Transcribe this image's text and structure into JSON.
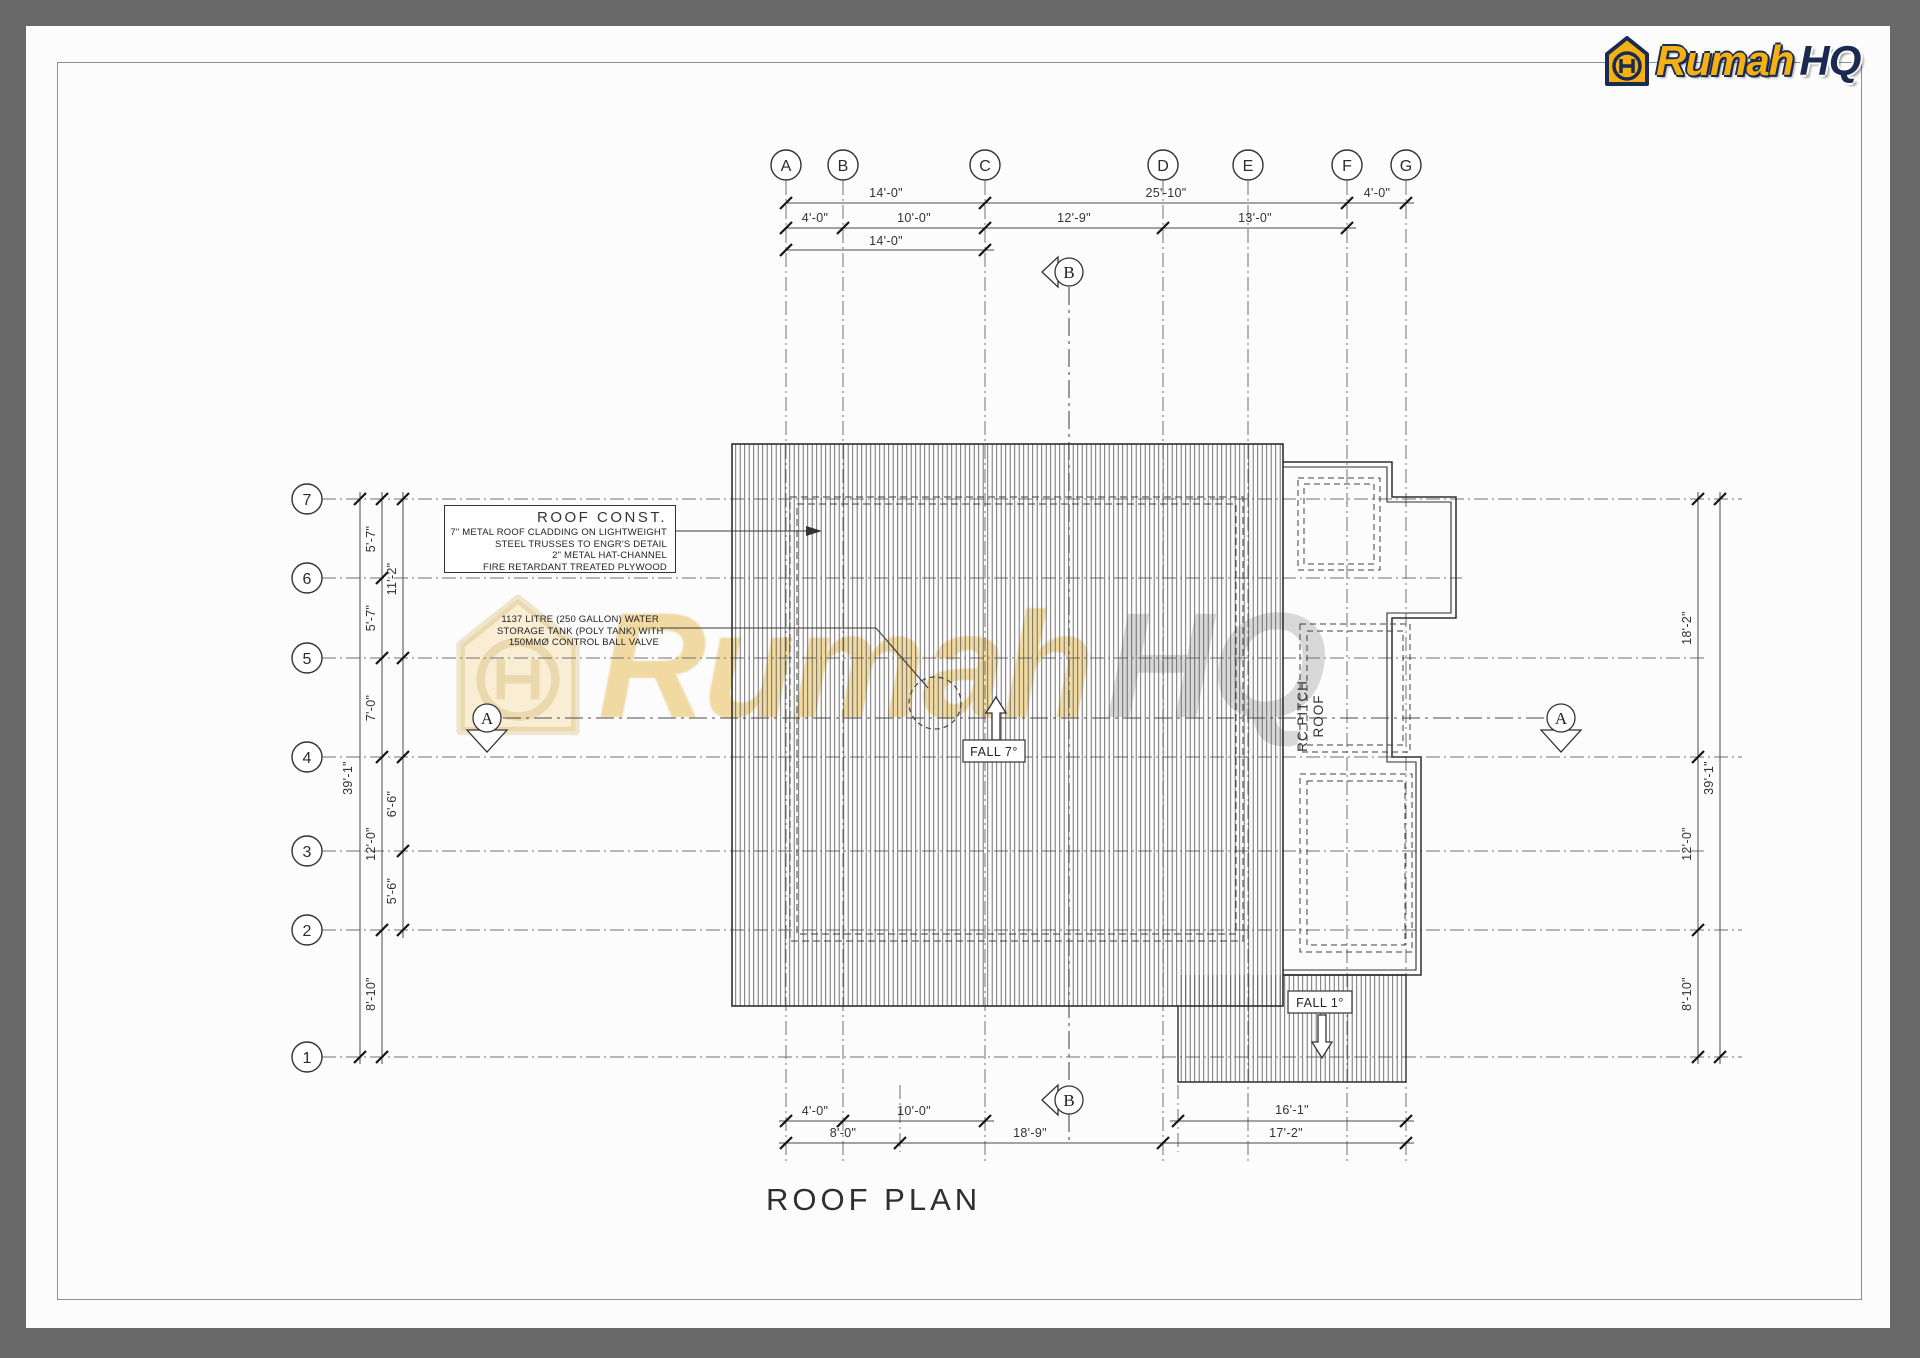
{
  "brand": {
    "prefix": "Rumah",
    "suffix": "HQ"
  },
  "watermark": {
    "prefix": "Rumah",
    "suffix": "HQ"
  },
  "drawing_title": "ROOF PLAN",
  "grid": {
    "columns": [
      "A",
      "B",
      "C",
      "D",
      "E",
      "F",
      "G"
    ],
    "rows": [
      "7",
      "6",
      "5",
      "4",
      "3",
      "2",
      "1"
    ]
  },
  "sections": {
    "a_left": "A",
    "a_right": "A",
    "b_top": "B",
    "b_bottom": "B"
  },
  "dims": {
    "top_row1": [
      "14'-0\"",
      "25'-10\"",
      "4'-0\""
    ],
    "top_row2": [
      "4'-0\"",
      "10'-0\"",
      "12'-9\"",
      "13'-0\""
    ],
    "top_row3": [
      "14'-0\""
    ],
    "left_overall": "39'-1\"",
    "left_chain": [
      "5'-7\"",
      "5'-7\"",
      "7'-0\"",
      "12'-0\"",
      "8'-10\""
    ],
    "left_outer": [
      "11'-2\"",
      "6'-6\"",
      "5'-6\""
    ],
    "right_chain": [
      "18'-2\"",
      "12'-0\"",
      "8'-10\""
    ],
    "right_overall": "39'-1\"",
    "bottom_row1": [
      "4'-0\"",
      "10'-0\""
    ],
    "bottom_row2": [
      "8'-0\"",
      "18'-9\""
    ],
    "bottom_right_row1": "16'-1\"",
    "bottom_right_row2": "17'-2\""
  },
  "notes": {
    "roof_const_heading": "ROOF CONST.",
    "roof_const_lines": [
      "7\" METAL ROOF CLADDING ON LIGHTWEIGHT",
      "STEEL TRUSSES TO ENGR'S DETAIL",
      "2\" METAL HAT-CHANNEL",
      "FIRE RETARDANT TREATED PLYWOOD"
    ],
    "water_tank_lines": [
      "1137 LITRE (250 GALLON) WATER",
      "STORAGE TANK (POLY TANK) WITH",
      "150MMØ CONTROL BALL VALVE"
    ],
    "rc_pitch_line1": "RC PITCH",
    "rc_pitch_line2": "ROOF",
    "fall_main": "FALL 7°",
    "fall_secondary": "FALL 1°"
  },
  "colors": {
    "line": "#2e2e2e",
    "grid_line": "#6f6f6f",
    "accent_yellow": "#f3b211",
    "navy": "#1c2951",
    "frame": "#696969"
  }
}
